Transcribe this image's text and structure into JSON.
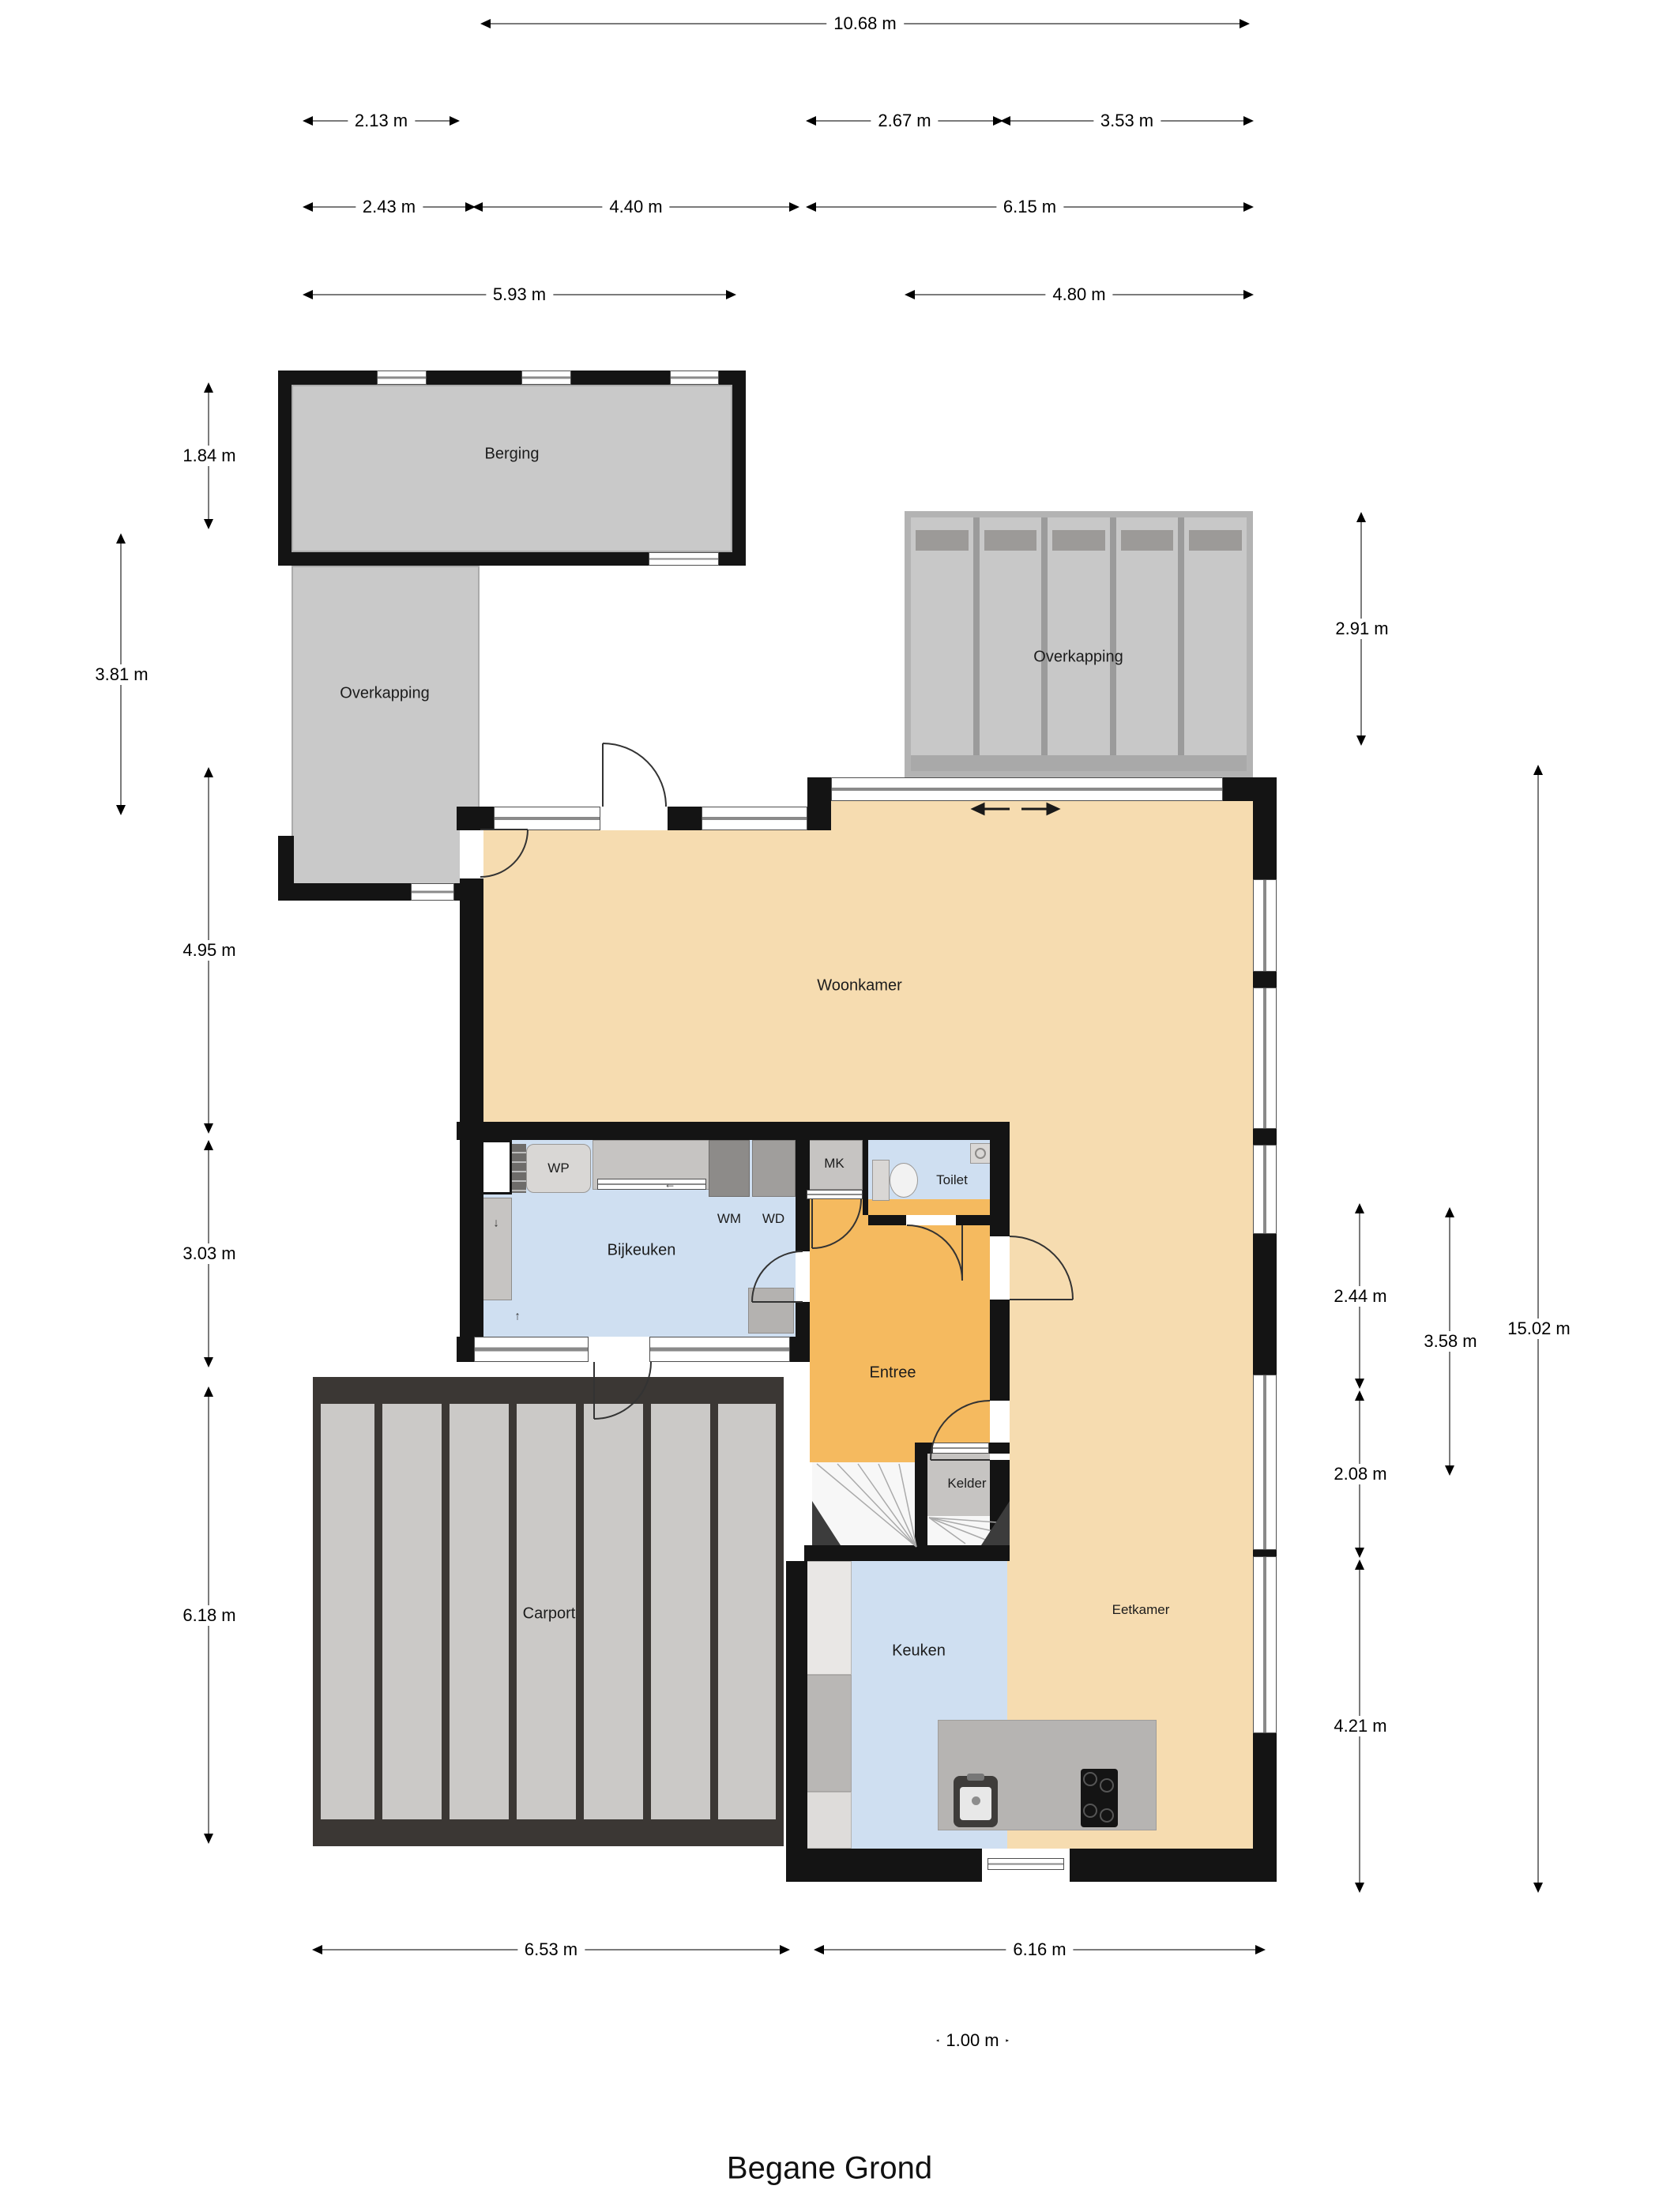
{
  "title": "Begane Grond",
  "rooms": {
    "berging": {
      "label": "Berging"
    },
    "overkapping_left": {
      "label": "Overkapping"
    },
    "overkapping_right": {
      "label": "Overkapping"
    },
    "woonkamer": {
      "label": "Woonkamer"
    },
    "bijkeuken": {
      "label": "Bijkeuken"
    },
    "entree": {
      "label": "Entree"
    },
    "toilet": {
      "label": "Toilet"
    },
    "kelder": {
      "label": "Kelder"
    },
    "keuken": {
      "label": "Keuken"
    },
    "eetkamer": {
      "label": "Eetkamer"
    },
    "carport": {
      "label": "Carport"
    }
  },
  "appliances": {
    "wp": {
      "label": "WP"
    },
    "wm": {
      "label": "WM"
    },
    "wd": {
      "label": "WD"
    },
    "mk": {
      "label": "MK"
    }
  },
  "dimensions": {
    "overall_top": {
      "label": "10.68 m"
    },
    "top_left_small": {
      "label": "2.13 m"
    },
    "top_mid": {
      "label": "2.67 m"
    },
    "top_right": {
      "label": "3.53 m"
    },
    "row3_a": {
      "label": "2.43 m"
    },
    "row3_b": {
      "label": "4.40 m"
    },
    "row3_c": {
      "label": "6.15 m"
    },
    "row4_a": {
      "label": "5.93 m"
    },
    "row4_b": {
      "label": "4.80 m"
    },
    "left_a": {
      "label": "1.84 m"
    },
    "left_b": {
      "label": "3.81 m"
    },
    "left_c": {
      "label": "4.95 m"
    },
    "left_d": {
      "label": "3.03 m"
    },
    "left_e": {
      "label": "6.18 m"
    },
    "right_a": {
      "label": "2.91 m"
    },
    "right_b": {
      "label": "2.44 m"
    },
    "right_c": {
      "label": "2.08 m"
    },
    "right_d": {
      "label": "4.21 m"
    },
    "right_e": {
      "label": "3.58 m"
    },
    "right_f": {
      "label": "15.02 m"
    },
    "bottom_a": {
      "label": "6.53 m"
    },
    "bottom_b": {
      "label": "6.16 m"
    },
    "bottom_c": {
      "label": "1.00 m"
    }
  },
  "colors": {
    "wall": "#141414",
    "living_floor": "#f6dcb0",
    "hall_floor": "#f5ba5f",
    "wet_room_floor": "#cfdff1",
    "outbuilding_gray": "#c9c9c9",
    "carport_dark": "#3b3734",
    "carport_panel": "#cbc9c7",
    "island_gray": "#b6b4b2",
    "dimension_line": "#7b7b7b"
  }
}
